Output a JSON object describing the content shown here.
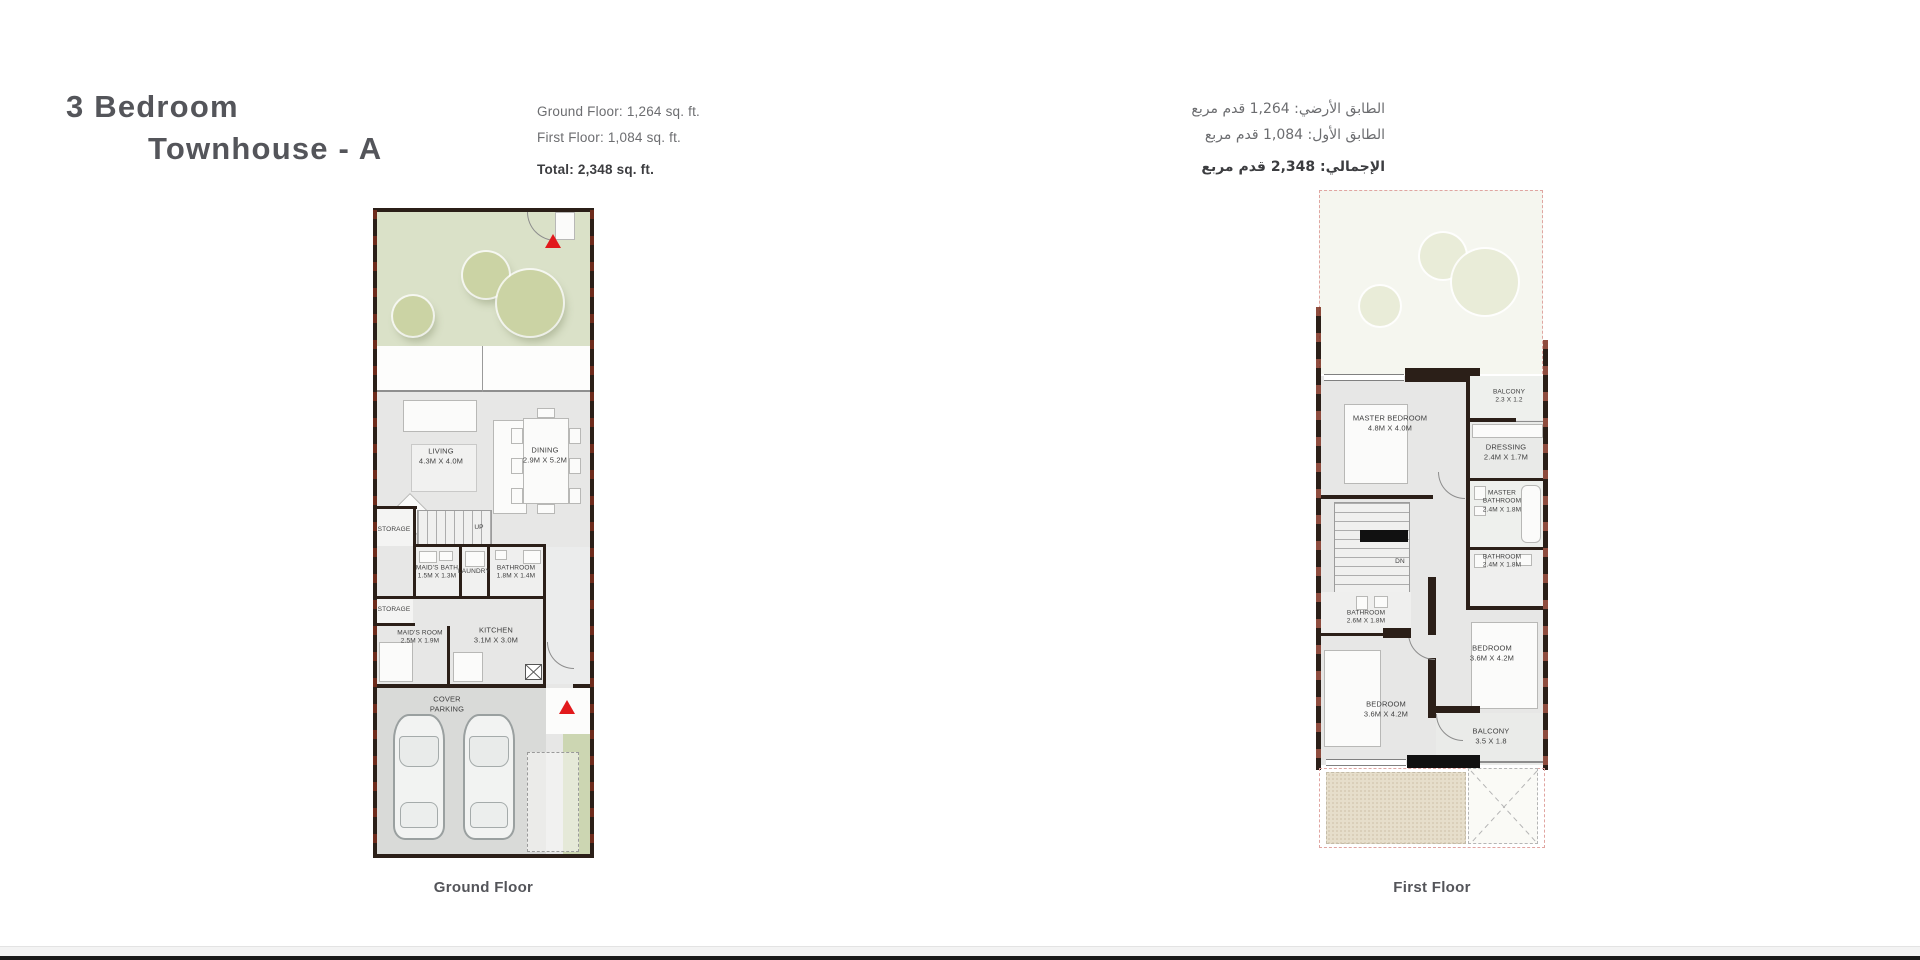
{
  "header": {
    "title_line1": "3 Bedroom",
    "title_line2": "Townhouse - A"
  },
  "stats_en": {
    "ground_floor": "Ground Floor: 1,264 sq. ft.",
    "first_floor": "First Floor: 1,084 sq. ft.",
    "total": "Total: 2,348 sq. ft."
  },
  "stats_ar": {
    "ground_floor": "الطابق الأرضي: 1,264 قدم مربع",
    "first_floor": "الطابق الأول: 1,084 قدم مربع",
    "total": "الإجمالي: 2,348 قدم مربع"
  },
  "ground_floor": {
    "caption": "Ground Floor",
    "rooms": {
      "living": {
        "name": "LIVING",
        "dims": "4.3M X 4.0M"
      },
      "dining": {
        "name": "DINING",
        "dims": "2.9M X 5.2M"
      },
      "storage_upper": {
        "name": "STORAGE"
      },
      "storage_lower": {
        "name": "STORAGE"
      },
      "maids_bath": {
        "name": "MAID'S BATH",
        "dims": "1.5M X 1.3M"
      },
      "laundry": {
        "name": "LAUNDRY"
      },
      "bathroom": {
        "name": "BATHROOM",
        "dims": "1.8M X 1.4M"
      },
      "maids_room": {
        "name": "MAID'S ROOM",
        "dims": "2.5M X 1.9M"
      },
      "kitchen": {
        "name": "KITCHEN",
        "dims": "3.1M X 3.0M"
      },
      "cover_parking": {
        "name": "COVER PARKING"
      },
      "stairs_label": "UP"
    }
  },
  "first_floor": {
    "caption": "First Floor",
    "rooms": {
      "balcony_top": {
        "name": "BALCONY",
        "dims": "2.3 X 1.2"
      },
      "master_bedroom": {
        "name": "MASTER BEDROOM",
        "dims": "4.8M X 4.0M"
      },
      "dressing": {
        "name": "DRESSING",
        "dims": "2.4M X 1.7M"
      },
      "master_bathroom": {
        "name": "MASTER BATHROOM",
        "dims": "2.4M X 1.8M"
      },
      "bathroom_right": {
        "name": "BATHROOM",
        "dims": "2.4M X 1.8M"
      },
      "bathroom_left": {
        "name": "BATHROOM",
        "dims": "2.6M X 1.8M"
      },
      "bedroom_right": {
        "name": "BEDROOM",
        "dims": "3.6M X 4.2M"
      },
      "bedroom_left": {
        "name": "BEDROOM",
        "dims": "3.6M X 4.2M"
      },
      "balcony_bottom": {
        "name": "BALCONY",
        "dims": "3.5 X 1.8"
      },
      "stairs_label": "DN"
    }
  },
  "colors": {
    "accent_red": "#e2191c",
    "wall": "#2b1f18",
    "garden_green": "#dae1c8",
    "tree": "#cbd3a4",
    "plan_gray": "#e7e7e6",
    "dashed_pink": "#e0a5a1",
    "sand": "#e6decb"
  }
}
